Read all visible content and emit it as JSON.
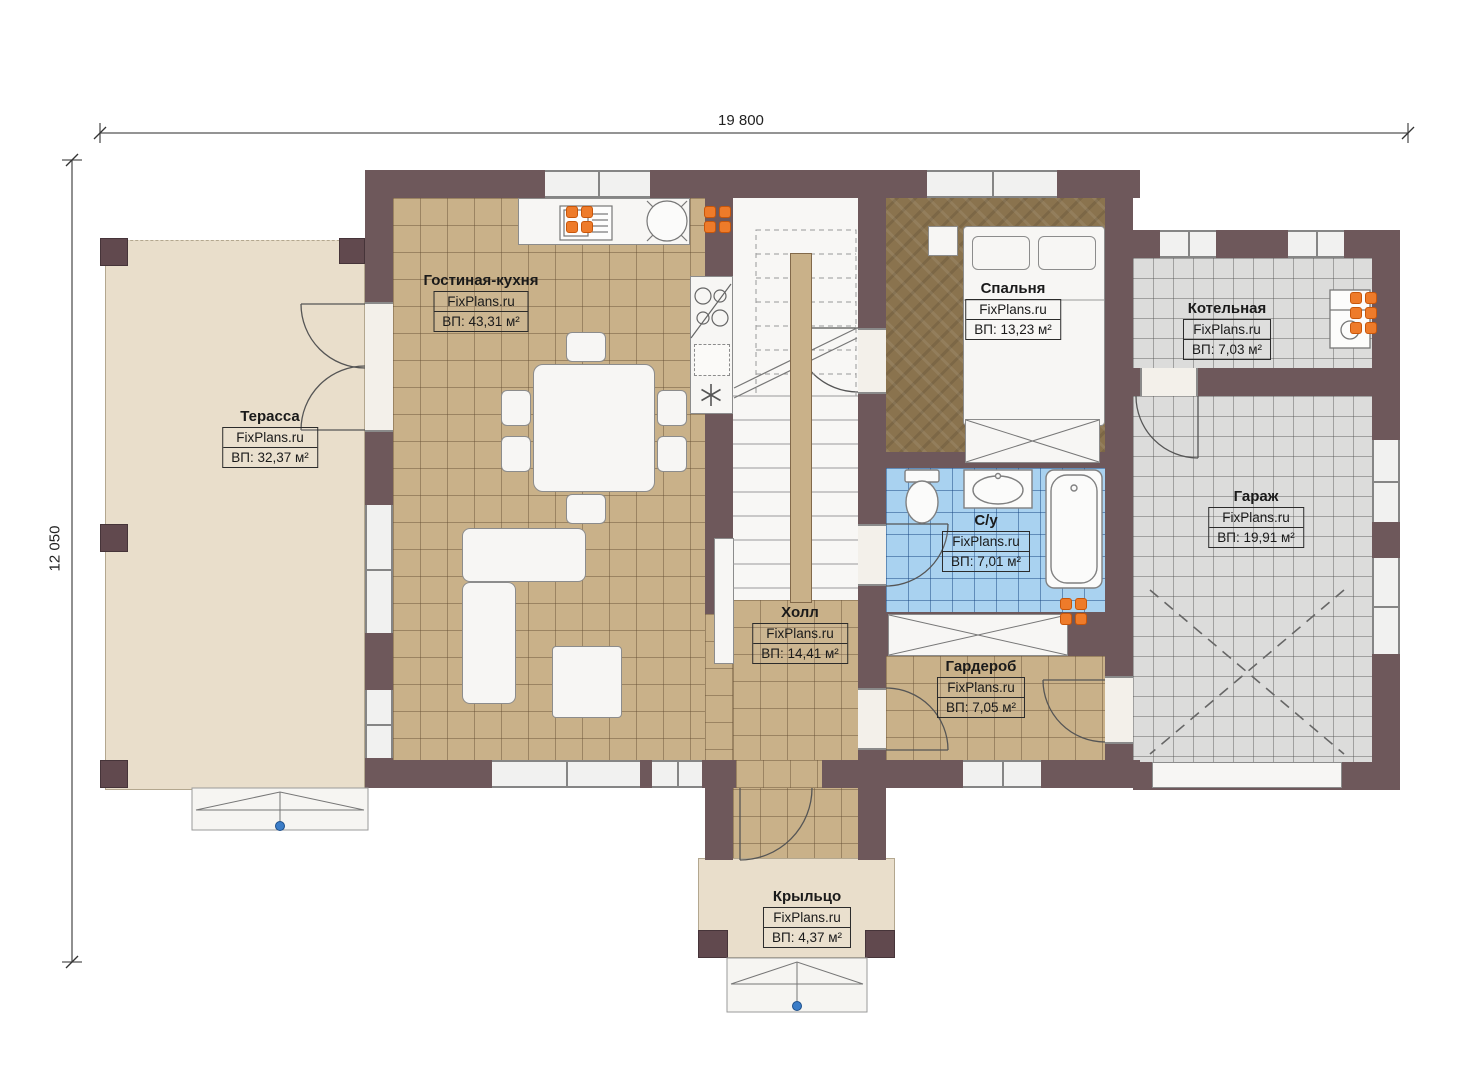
{
  "brand": "FixPlans.ru",
  "dimensions": {
    "top": "19 800",
    "left": "12 050"
  },
  "rooms": [
    {
      "id": "terrace",
      "name": "Терасса",
      "area": "ВП: 32,37 м²"
    },
    {
      "id": "living",
      "name": "Гостиная-кухня",
      "area": "ВП: 43,31 м²"
    },
    {
      "id": "hall",
      "name": "Холл",
      "area": "ВП: 14,41 м²"
    },
    {
      "id": "bedroom",
      "name": "Спальня",
      "area": "ВП: 13,23 м²"
    },
    {
      "id": "bathroom",
      "name": "С/у",
      "area": "ВП: 7,01 м²"
    },
    {
      "id": "wardrobe",
      "name": "Гардероб",
      "area": "ВП: 7,05 м²"
    },
    {
      "id": "boiler",
      "name": "Котельная",
      "area": "ВП: 7,03 м²"
    },
    {
      "id": "garage",
      "name": "Гараж",
      "area": "ВП: 19,91 м²"
    },
    {
      "id": "porch",
      "name": "Крыльцо",
      "area": "ВП: 4,37 м²"
    }
  ],
  "colors": {
    "wall": "#6e585b",
    "tile_tan": "#c9b189",
    "tile_gray": "#dcdcdb",
    "tile_blue": "#a9d2f0",
    "floor_bedroom": "#8a734e",
    "terrace": "#e9decb",
    "radiator": "#ee7b2a",
    "step_marker": "#3b7dc8"
  }
}
